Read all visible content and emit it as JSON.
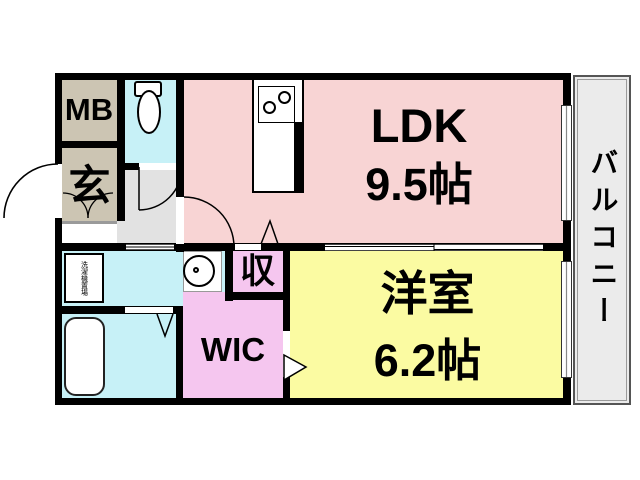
{
  "rooms": {
    "ldk": {
      "label": "LDK",
      "size": "9.5帖"
    },
    "western": {
      "label": "洋室",
      "size": "6.2帖"
    },
    "mb": {
      "label": "MB"
    },
    "genkan": {
      "label": "玄"
    },
    "storage": {
      "label": "収"
    },
    "wic": {
      "label": "WIC"
    },
    "balcony": {
      "label": "バルコニー"
    },
    "laundry": {
      "label": "洗濯機置場"
    }
  },
  "colors": {
    "wall": "#000000",
    "ldk_pink": "#f8d4d4",
    "western_yellow": "#fbfba2",
    "wet_cyan": "#c7f1f7",
    "closet_pink": "#f5c6ef",
    "entry_beige": "#ccc5b3",
    "hall_gray": "#e2e2e2",
    "balcony_gray": "#ebebeb"
  }
}
